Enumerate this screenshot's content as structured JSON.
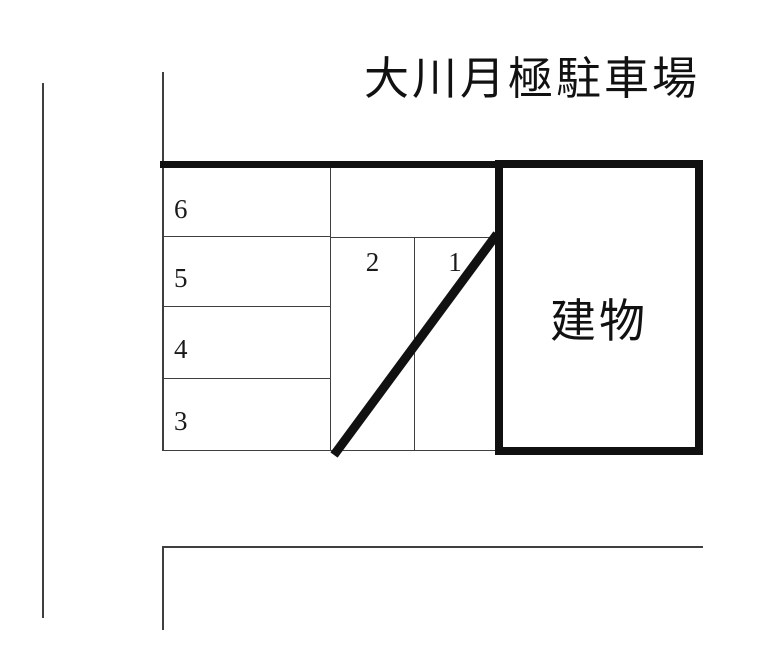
{
  "title": "大川月極駐車場",
  "building": {
    "label": "建物"
  },
  "spaces": {
    "left_column": [
      {
        "label": "6"
      },
      {
        "label": "5"
      },
      {
        "label": "4"
      },
      {
        "label": "3"
      }
    ],
    "middle_row": [
      {
        "label": "2"
      },
      {
        "label": "1"
      }
    ]
  },
  "colors": {
    "thick_line": "#111111",
    "thin_line": "#3f3f3f",
    "background": "#ffffff",
    "text": "#111111"
  }
}
